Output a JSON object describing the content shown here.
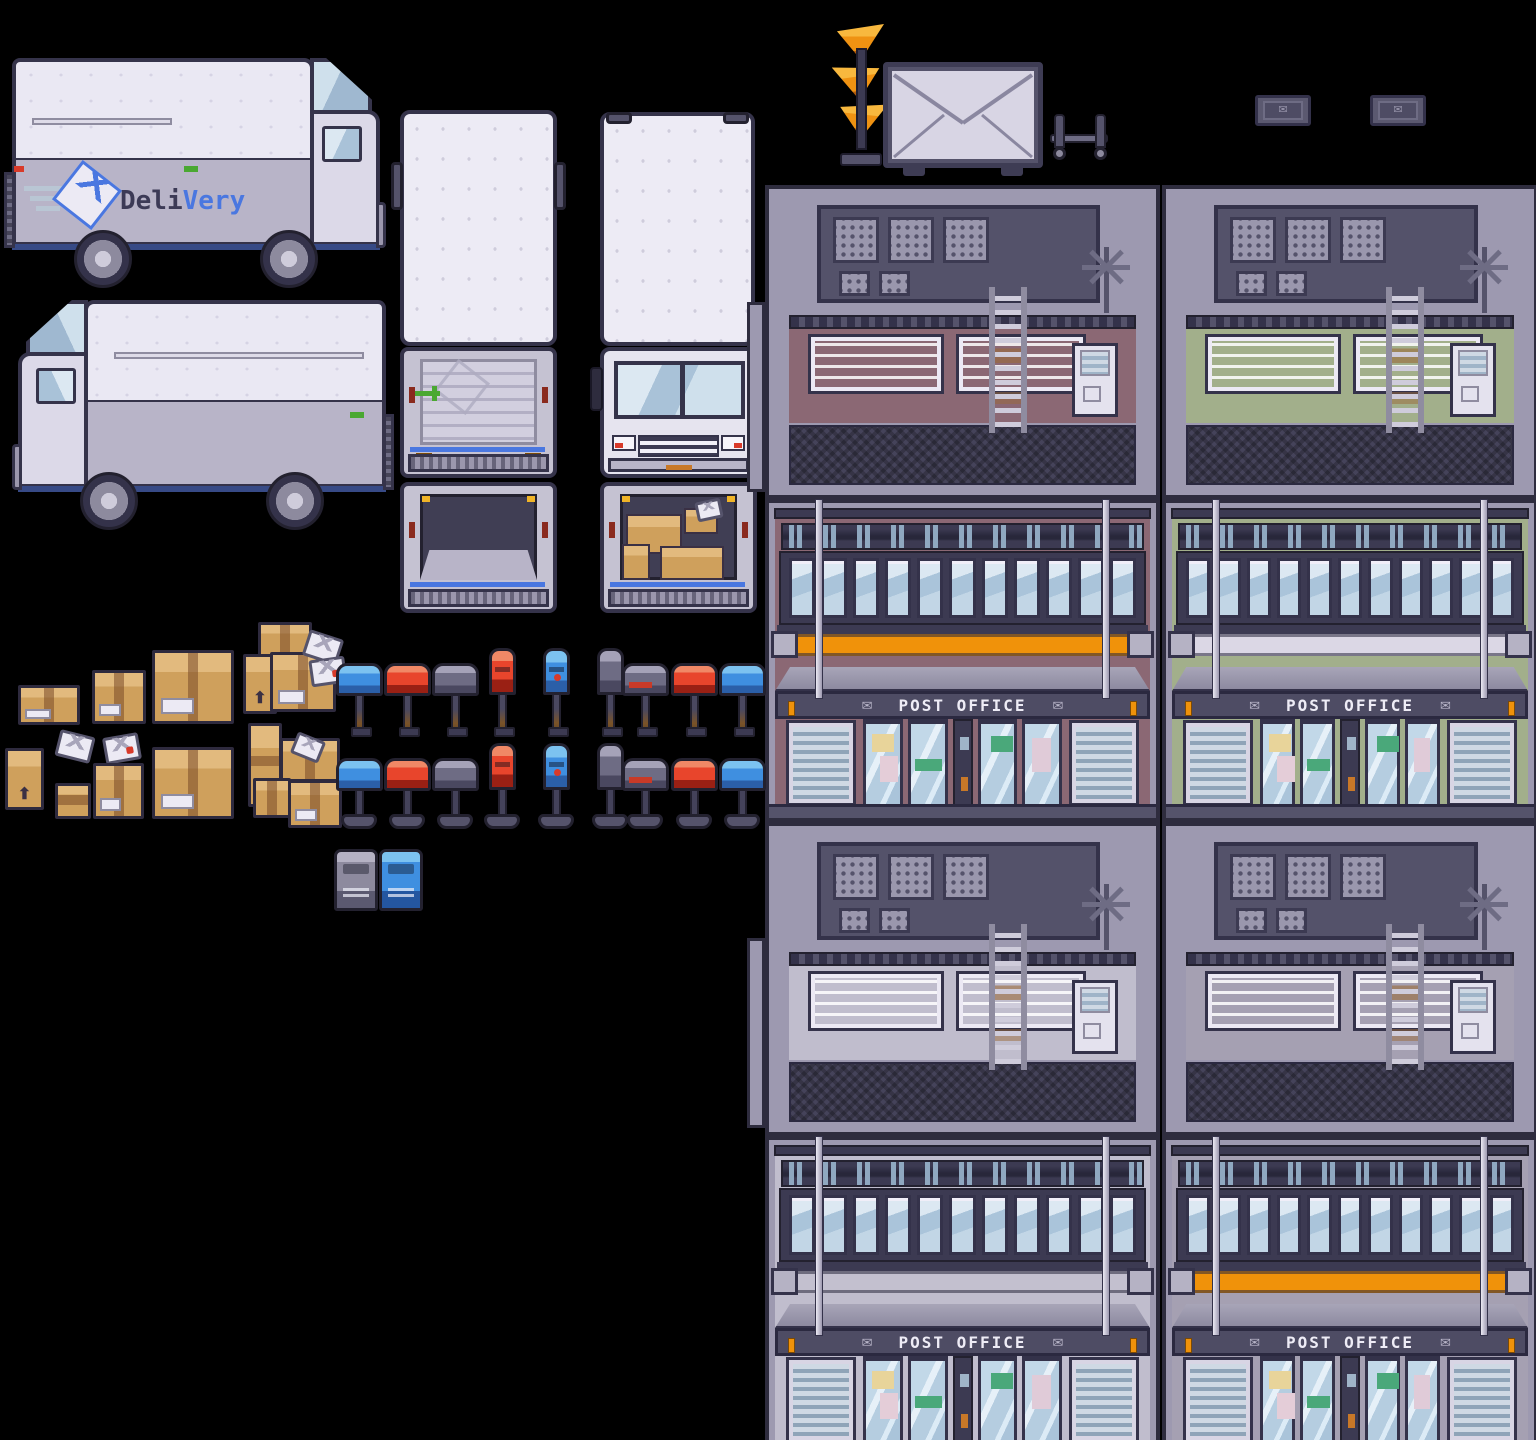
{
  "sheet": {
    "title": "post-office-delivery-spritesheet",
    "background": "#000000"
  },
  "truck": {
    "brand_dark": "Deli",
    "brand_blue": "Very",
    "colors": {
      "body": "#eae8f3",
      "lower_panel": "#b8b4c8",
      "stripe_blue": "#4a77e0",
      "outline": "#35334a",
      "glass": "#a9c2d8",
      "logo_blue": "#4a77e0"
    },
    "views": [
      "side-right",
      "side-left",
      "top",
      "rear-closed",
      "rear-open-empty",
      "front",
      "rear-open-packages"
    ]
  },
  "post_office": {
    "sign_label": "POST OFFICE",
    "sign_icon": "envelope",
    "buildings": [
      {
        "id": "mauve-orange",
        "wall": "#8b6874",
        "stripe": "#f0920a"
      },
      {
        "id": "green-white",
        "wall": "#a2af8b",
        "stripe": "#dbd7e5"
      },
      {
        "id": "gray-gray",
        "wall": "#c0bdcd",
        "stripe": "#c3c0cf"
      },
      {
        "id": "gray-orange",
        "wall": "#a5a0b2",
        "stripe": "#f0920a"
      }
    ],
    "window_count": 11,
    "roof_items": [
      "ac-unit",
      "ac-unit",
      "ac-unit",
      "ac-unit-small",
      "ac-unit-small",
      "antenna",
      "ladder"
    ]
  },
  "mailboxes": {
    "row1_mount": "rusted-pole",
    "row2_mount": "round-base",
    "items": [
      "blue-side",
      "red-side",
      "gray-side",
      "red-front",
      "blue-front",
      "gray-back",
      "gray-red-side",
      "red-side",
      "blue-side"
    ],
    "colors": {
      "blue": "#3f8fe0",
      "red": "#e8452c",
      "gray": "#6e6c84"
    }
  },
  "lockers": [
    "gray",
    "blue"
  ],
  "props": {
    "sculpture": "orange-horn-stack",
    "envelope_sign": "envelope-billboard",
    "cart": "luggage-cart",
    "plaques": [
      "envelope-plaque",
      "envelope-plaque"
    ],
    "plaque_icon": "✉",
    "awning_icon": "✉"
  },
  "packages": {
    "box_color": "#cfa05c",
    "tape_color": "#7a4a28",
    "types": [
      "small-box",
      "medium-box",
      "large-box",
      "tall-box",
      "box-stack",
      "envelope",
      "envelope-stamped"
    ]
  }
}
